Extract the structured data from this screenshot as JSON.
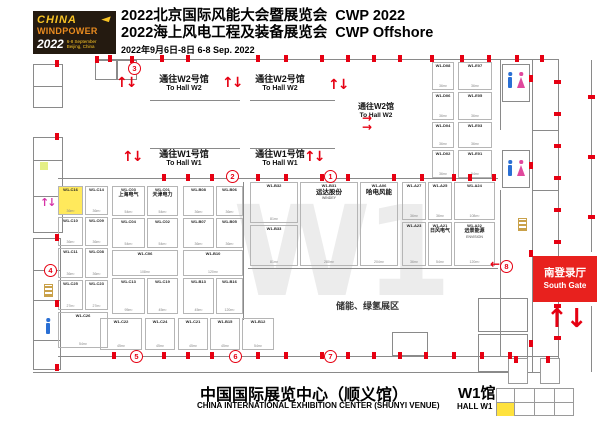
{
  "header": {
    "logo": {
      "brand1": "CHINA",
      "brand2": "WINDPOWER",
      "year": "2022",
      "dates": "6-8 September",
      "place": "Beijing, China"
    },
    "title1_cn": "2022北京国际风能大会暨展览会",
    "title1_en": "CWP 2022",
    "title2_cn": "2022海上风电工程及装备展览会",
    "title2_en": "CWP Offshore",
    "date_line": "2022年9月6日-8日  6-8 Sep. 2022"
  },
  "plan": {
    "watermark": "W1",
    "zone_label": "储能、绿氢展区",
    "south_gate": {
      "cn": "南登录厅",
      "en": "South Gate"
    },
    "hall_links": [
      {
        "cn": "通往W2号馆",
        "en": "To Hall W2"
      },
      {
        "cn": "通往W2号馆",
        "en": "To Hall W2"
      },
      {
        "cn": "通往W1号馆",
        "en": "To Hall W1"
      },
      {
        "cn": "通往W1号馆",
        "en": "To Hall W1"
      },
      {
        "cn": "通往W2馆",
        "en": "To Hall W2"
      }
    ],
    "gates": [
      {
        "n": "3",
        "x": 128,
        "y": 62
      },
      {
        "n": "2",
        "x": 226,
        "y": 170
      },
      {
        "n": "1",
        "x": 324,
        "y": 170
      },
      {
        "n": "4",
        "x": 44,
        "y": 264
      },
      {
        "n": "5",
        "x": 130,
        "y": 350
      },
      {
        "n": "6",
        "x": 229,
        "y": 350
      },
      {
        "n": "7",
        "x": 324,
        "y": 350
      },
      {
        "n": "8",
        "x": 500,
        "y": 260
      }
    ],
    "booths": [
      {
        "code": "W1-C16",
        "size": "36m²",
        "x": 58,
        "y": 186,
        "w": 25,
        "h": 29,
        "hl": true
      },
      {
        "code": "W1-C14",
        "size": "36m²",
        "x": 85,
        "y": 186,
        "w": 23,
        "h": 29
      },
      {
        "code": "W1-C10",
        "size": "36m²",
        "x": 58,
        "y": 217,
        "w": 25,
        "h": 29
      },
      {
        "code": "W1-C09",
        "size": "36m²",
        "x": 85,
        "y": 217,
        "w": 23,
        "h": 29
      },
      {
        "code": "W1-C11",
        "size": "36m²",
        "x": 58,
        "y": 248,
        "w": 25,
        "h": 30
      },
      {
        "code": "W1-C08",
        "size": "36m²",
        "x": 85,
        "y": 248,
        "w": 23,
        "h": 30
      },
      {
        "code": "W1-C25",
        "size": "27m²",
        "x": 58,
        "y": 280,
        "w": 25,
        "h": 30
      },
      {
        "code": "W1-C23",
        "size": "27m²",
        "x": 85,
        "y": 280,
        "w": 23,
        "h": 30
      },
      {
        "code": "W1-C26",
        "size": "54m²",
        "x": 58,
        "y": 312,
        "w": 50,
        "h": 36
      },
      {
        "code": "W1-C03",
        "name": "上海电气",
        "size": "54m²",
        "x": 112,
        "y": 186,
        "w": 33,
        "h": 30
      },
      {
        "code": "W1-C01",
        "name": "天津电力",
        "size": "54m²",
        "x": 147,
        "y": 186,
        "w": 31,
        "h": 30
      },
      {
        "code": "W1-C04",
        "size": "54m²",
        "x": 112,
        "y": 218,
        "w": 33,
        "h": 30
      },
      {
        "code": "W1-C02",
        "size": "54m²",
        "x": 147,
        "y": 218,
        "w": 31,
        "h": 30
      },
      {
        "code": "W1-C06",
        "size": "108m²",
        "x": 112,
        "y": 250,
        "w": 66,
        "h": 26
      },
      {
        "code": "W1-C13",
        "size": "95m²",
        "x": 112,
        "y": 278,
        "w": 33,
        "h": 36
      },
      {
        "code": "W1-C19",
        "size": "45m²",
        "x": 147,
        "y": 278,
        "w": 31,
        "h": 36
      },
      {
        "code": "W1-B08",
        "size": "36m²",
        "x": 183,
        "y": 186,
        "w": 31,
        "h": 30
      },
      {
        "code": "W1-B06",
        "size": "36m²",
        "x": 216,
        "y": 186,
        "w": 27,
        "h": 30
      },
      {
        "code": "W1-B07",
        "size": "36m²",
        "x": 183,
        "y": 218,
        "w": 31,
        "h": 30
      },
      {
        "code": "W1-B05",
        "size": "36m²",
        "x": 216,
        "y": 218,
        "w": 27,
        "h": 30
      },
      {
        "code": "W1-B10",
        "size": "120m²",
        "x": 183,
        "y": 250,
        "w": 60,
        "h": 26
      },
      {
        "code": "W1-B13",
        "size": "45m²",
        "x": 183,
        "y": 278,
        "w": 31,
        "h": 36
      },
      {
        "code": "W1-B16",
        "size": "120m²",
        "x": 216,
        "y": 278,
        "w": 27,
        "h": 36
      },
      {
        "code": "W1-C22",
        "size": "45m²",
        "x": 100,
        "y": 318,
        "w": 42,
        "h": 32
      },
      {
        "code": "W1-C24",
        "size": "45m²",
        "x": 145,
        "y": 318,
        "w": 30,
        "h": 32
      },
      {
        "code": "W1-C21",
        "size": "45m²",
        "x": 178,
        "y": 318,
        "w": 30,
        "h": 32
      },
      {
        "code": "W1-B15",
        "size": "45m²",
        "x": 210,
        "y": 318,
        "w": 30,
        "h": 32
      },
      {
        "code": "W1-B12",
        "size": "54m²",
        "x": 242,
        "y": 318,
        "w": 32,
        "h": 32
      },
      {
        "code": "W1-B32",
        "size": "81m²",
        "x": 250,
        "y": 182,
        "w": 48,
        "h": 41
      },
      {
        "code": "W1-B33",
        "size": "81m²",
        "x": 250,
        "y": 225,
        "w": 48,
        "h": 41
      },
      {
        "code": "W1-B31",
        "name": "运达股份",
        "name2": "WINDEY",
        "size": "280m²",
        "x": 300,
        "y": 182,
        "w": 58,
        "h": 84,
        "big": true
      },
      {
        "code": "W1-A06",
        "name": "哈电风能",
        "size": "204m²",
        "x": 360,
        "y": 182,
        "w": 38,
        "h": 84,
        "big": true
      },
      {
        "code": "W1-A27",
        "size": "36m²",
        "x": 402,
        "y": 182,
        "w": 24,
        "h": 38
      },
      {
        "code": "W1-A25",
        "size": "36m²",
        "x": 428,
        "y": 182,
        "w": 24,
        "h": 38
      },
      {
        "code": "W1-A23",
        "size": "36m²",
        "x": 402,
        "y": 222,
        "w": 24,
        "h": 44
      },
      {
        "code": "W1-A21",
        "name": "日风电气",
        "size": "54m²",
        "x": 428,
        "y": 222,
        "w": 24,
        "h": 44
      },
      {
        "code": "W1-A24",
        "size": "108m²",
        "x": 454,
        "y": 182,
        "w": 41,
        "h": 38
      },
      {
        "code": "W1-A22",
        "name": "远景能源",
        "name2": "ENVISION",
        "size": "120m²",
        "x": 454,
        "y": 222,
        "w": 41,
        "h": 44
      },
      {
        "code": "W1-D08",
        "size": "36m²",
        "x": 432,
        "y": 62,
        "w": 22,
        "h": 28
      },
      {
        "code": "W1-D06",
        "size": "36m²",
        "x": 432,
        "y": 92,
        "w": 22,
        "h": 28
      },
      {
        "code": "W1-D04",
        "size": "36m²",
        "x": 432,
        "y": 122,
        "w": 22,
        "h": 26
      },
      {
        "code": "W1-D02",
        "size": "36m²",
        "x": 432,
        "y": 150,
        "w": 22,
        "h": 28
      },
      {
        "code": "W1-E07",
        "size": "36m²",
        "x": 458,
        "y": 62,
        "w": 34,
        "h": 28
      },
      {
        "code": "W1-E05",
        "size": "36m²",
        "x": 458,
        "y": 92,
        "w": 34,
        "h": 28
      },
      {
        "code": "W1-E03",
        "size": "36m²",
        "x": 458,
        "y": 122,
        "w": 34,
        "h": 26
      },
      {
        "code": "W1-E01",
        "size": "54m²",
        "x": 458,
        "y": 150,
        "w": 34,
        "h": 28
      }
    ]
  },
  "footer": {
    "venue_cn": "中国国际展览中心（顺义馆）",
    "venue_en": "CHINA INTERNATIONAL EXHIBITION CENTER (SHUNYI VENUE)",
    "hall_cn": "W1馆",
    "hall_en": "HALL W1"
  },
  "colors": {
    "accent_red": "#e60012",
    "logo_bg": "#241a10",
    "logo_yellow": "#f7c325",
    "logo_orange": "#e98b1f",
    "watermark_gray": "#ececec",
    "booth_line": "#b5b5b5",
    "toilet_blue": "#2a6fd4",
    "toilet_pink": "#e0489d",
    "highlight_yellow": "#ffe95c",
    "south_gate_red": "#e8211e"
  }
}
